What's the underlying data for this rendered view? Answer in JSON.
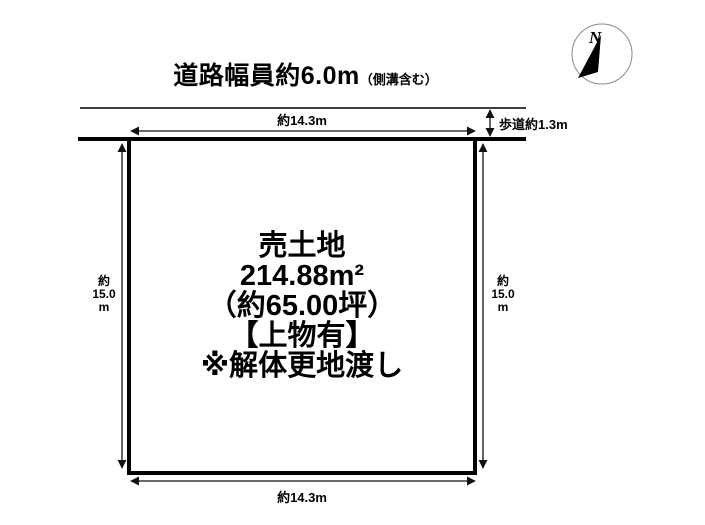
{
  "title": {
    "main": "道路幅員約6.0m",
    "sub": "（側溝含む）"
  },
  "compass": {
    "label": "N"
  },
  "road": {
    "sidewalk_label": "歩道約1.3m"
  },
  "dimensions": {
    "top": "約14.3m",
    "bottom": "約14.3m",
    "left": "約\n15.0\nm",
    "right": "約\n15.0\nm"
  },
  "plot": {
    "lines": [
      "売土地",
      "214.88m²",
      "（約65.00坪）",
      "【上物有】",
      "※解体更地渡し"
    ]
  },
  "colors": {
    "ink": "#000000",
    "background": "#ffffff",
    "compass_ring": "#8a8a8a"
  }
}
